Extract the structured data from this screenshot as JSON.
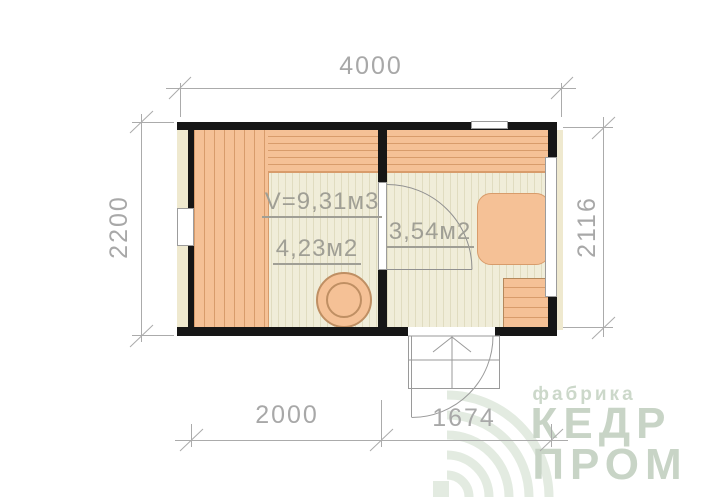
{
  "dimensions": {
    "top": "4000",
    "left": "2200",
    "right": "2116",
    "bottom_left": "2000",
    "bottom_right": "1674"
  },
  "rooms": {
    "steam_room": {
      "volume_label": "V=9,31м3",
      "area_label": "4,23м2"
    },
    "entry_room": {
      "area_label": "3,54м2"
    }
  },
  "watermark": {
    "tagline": "фабрика",
    "brand_top": "КЕДР",
    "brand_bottom": "ПРОМ"
  },
  "colors": {
    "wall": "#161616",
    "wood": "#f5c196",
    "wood_line": "#d89c6b",
    "floor": "#f0edd9",
    "floor_line": "#e0dcc0",
    "cream_panel": "#efe9cf",
    "dim_line": "#ababab",
    "dim_text": "#a8a8a8",
    "label_text": "#a09f95",
    "door_line": "#909090",
    "window_border": "#9c9c9c",
    "logo_text": "#c8d4c6",
    "logo_tagline": "#ccd8ca",
    "logo_mark": "#e3ebe1"
  }
}
